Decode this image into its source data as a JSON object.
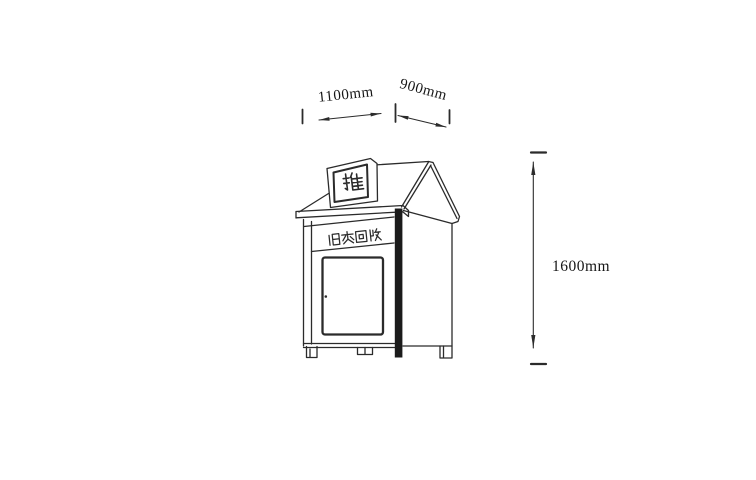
{
  "figure": {
    "kind": "technical line drawing of a clothes recycling bin",
    "labels": {
      "chute": "推",
      "front": "旧衣回收"
    },
    "dimensions": {
      "front_width": "1100mm",
      "side_depth": "900mm",
      "height": "1600mm"
    },
    "colors": {
      "ink": "#2b2b2b",
      "background": "#ffffff"
    }
  }
}
